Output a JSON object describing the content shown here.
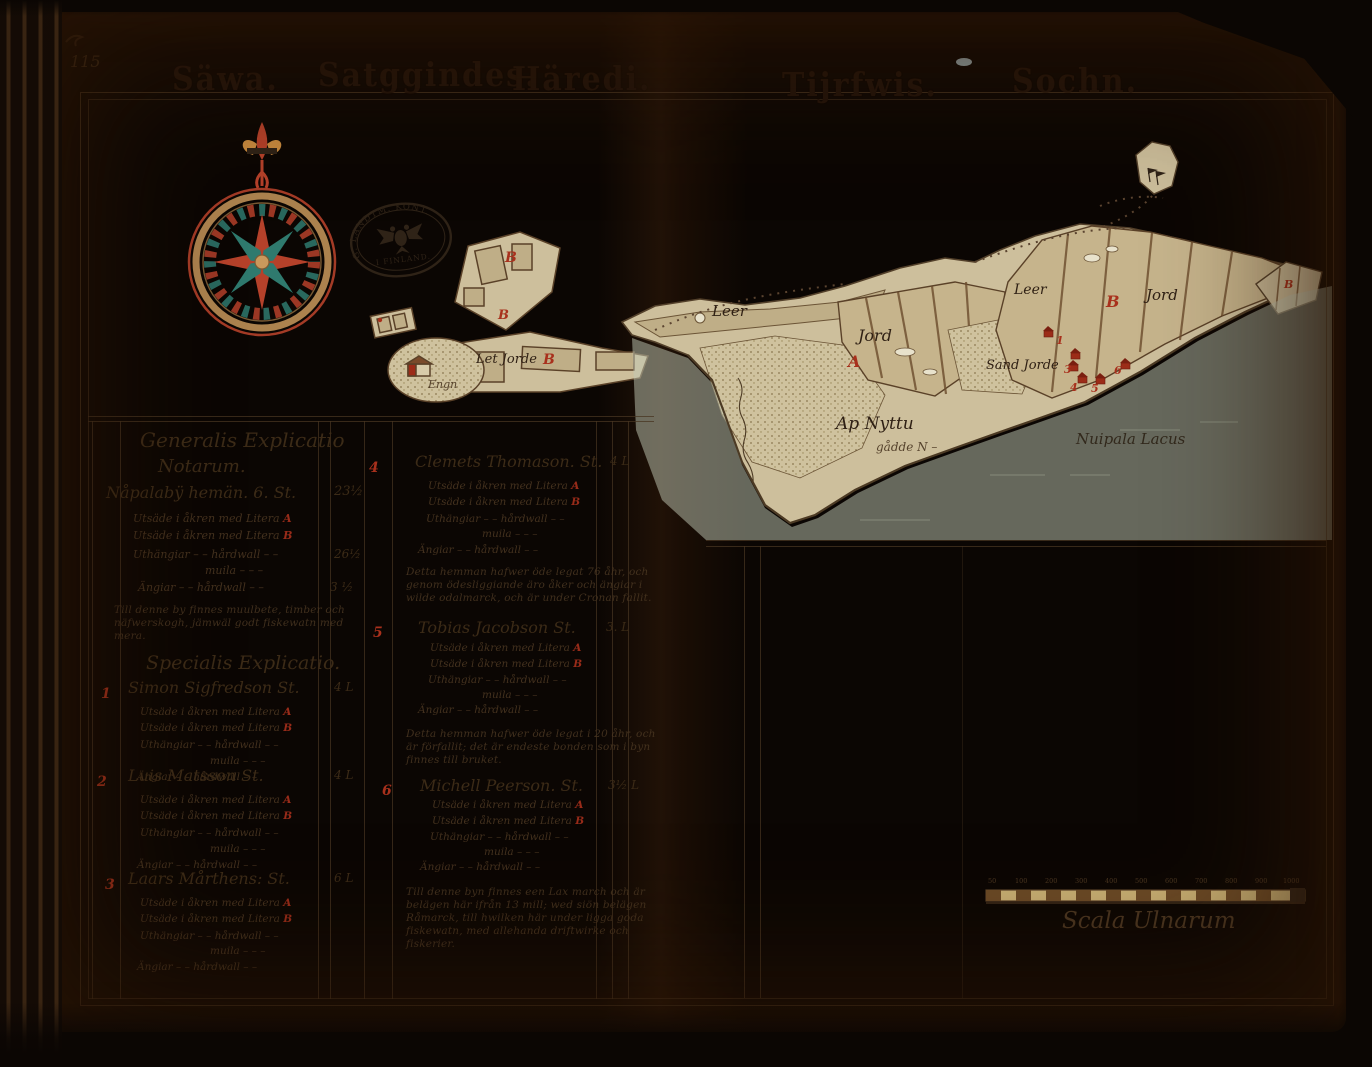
{
  "page_number": "115",
  "titles": {
    "word1": "Säwa.",
    "word2": "Satggindes.",
    "word3": "Häredi.",
    "word4": "Tijrfwis.",
    "word5": "Sochn."
  },
  "stamp": {
    "arc_text": "G. LANDTM. KONT.",
    "bottom_text": "I FINLAND."
  },
  "generalis": {
    "heading_line1": "Generalis Explicatio",
    "heading_line2": "Notarum.",
    "holding": "Nåpalabÿ hemän. 6. St.",
    "holding_value": "23½",
    "line_a": "Utsäde i åkren med Litera",
    "line_b": "Utsäde i åkren med Litera",
    "line_uth": "Uthängiar – – hårdwall – –",
    "uth_value": "26½",
    "line_muila": "muila – – –",
    "line_ang": "Ängiar – – hårdwall – –",
    "ang_value": "3 ½",
    "note": "Till denne by finnes muulbete, timber och näfwerskogh, jämwäl godt fiskewatn med mera."
  },
  "specialis": {
    "heading": "Specialis Explicatio.",
    "sub": {
      "line_a": "Utsäde i åkren med Litera",
      "letter_a": "A",
      "line_b": "Utsäde i åkren med Litera",
      "letter_b": "B",
      "line_uth": "Uthängiar – – hårdwall – –",
      "line_muila": "muila – – –",
      "line_ang": "Ängiar – – hårdwall – –"
    },
    "entries": [
      {
        "no": "1",
        "name": "Simon Sigfredson St.",
        "value": "4 L"
      },
      {
        "no": "2",
        "name": "Luis Matsson St.",
        "value": "4 L"
      },
      {
        "no": "3",
        "name": "Laars Mårthens: St.",
        "value": "6 L"
      },
      {
        "no": "4",
        "name": "Clemets Thomason. St.",
        "value": "4 L",
        "note": "Detta hemman hafwer öde legat 76 åhr, och genom ödesliggiande äro åker och ängiar i wilde odalmarck, och är under Cronan fallit."
      },
      {
        "no": "5",
        "name": "Tobias Jacobson St.",
        "value": "3. L",
        "note": "Detta hemman hafwer öde legat i 20 åhr, och är förfallit; det är endeste bonden som i byn finnes till bruket."
      },
      {
        "no": "6",
        "name": "Michell Peerson. St.",
        "value": "3½ L",
        "note": "Till denne byn finnes een Lax march och är belägen här ifrån 13 mill; wed siön belägen Råmarck, till hwilken här under ligga goda fiskewatn, med allehanda driftwirke och fiskerier."
      }
    ]
  },
  "map": {
    "left_cluster": {
      "label": "Let Jorde",
      "letter": "B",
      "caption": "Engn"
    },
    "labels": {
      "leer_w": "Leer",
      "jord_w": "Jord",
      "letter_a": "A",
      "meadow_1": "Ap Nyttu",
      "meadow_2": "gådde N –",
      "sand": "Sand Jorde",
      "leer_e": "Leer",
      "letter_b": "B",
      "jord_e": "Jord"
    },
    "house_numbers": [
      "1",
      "3",
      "4",
      "5",
      "6"
    ],
    "lake_label": "Nuipala Lacus",
    "scale_label": "Scala Ulnarum",
    "scale_ticks": [
      "50",
      "100",
      "200",
      "300",
      "400",
      "500",
      "600",
      "700",
      "800",
      "900",
      "1000"
    ]
  },
  "colors": {
    "ink": "#3c2b17",
    "red": "#a8301c",
    "teal": "#2f7a6e",
    "parchment": "#cdbf9c"
  }
}
